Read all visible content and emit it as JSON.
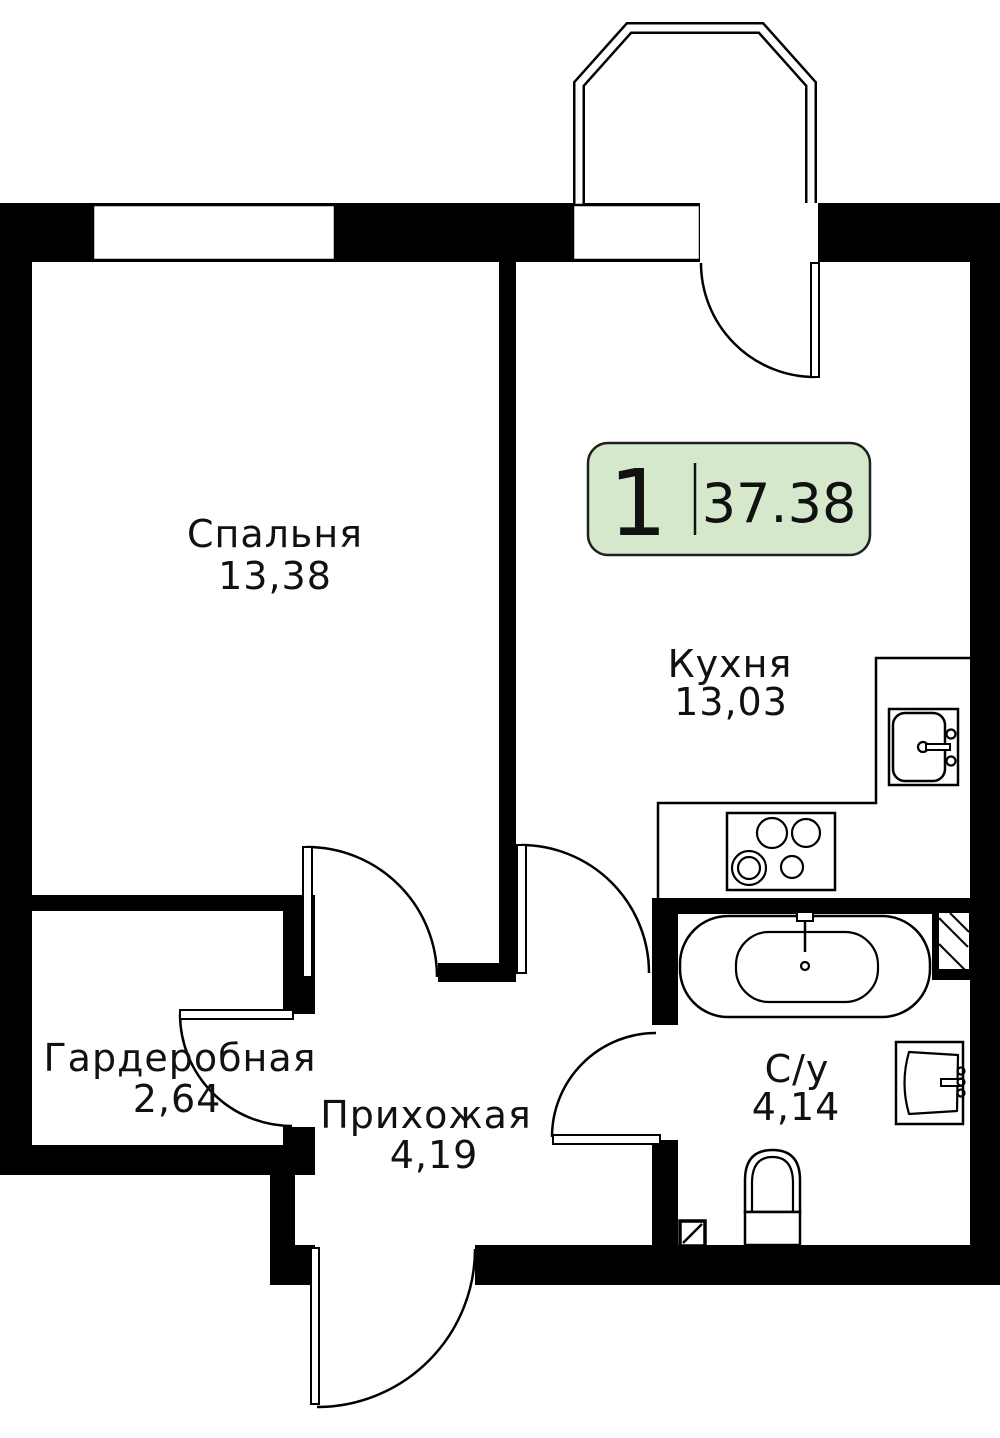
{
  "floorplan": {
    "type": "apartment-floor-plan",
    "badge": {
      "room_count": "1",
      "total_area": "37.38"
    },
    "rooms": [
      {
        "name": "Спальня",
        "area": "13,38"
      },
      {
        "name": "Кухня",
        "area": "13,03"
      },
      {
        "name": "Гардеробная",
        "area": "2,64"
      },
      {
        "name": "Прихожая",
        "area": "4,19"
      },
      {
        "name": "С/у",
        "area": "4,14"
      }
    ],
    "colors": {
      "wall": "#000000",
      "background": "#ffffff",
      "badge_fill": "#d5e8cc",
      "badge_border": "#1f1f1f",
      "text": "#111111"
    },
    "fixtures": [
      "bay-window",
      "bedroom-window",
      "balcony-door",
      "bedroom-door",
      "kitchen-door",
      "wardrobe-door",
      "bathroom-door",
      "entrance-door",
      "kitchen-counter",
      "kitchen-sink",
      "cooktop",
      "bathtub",
      "wash-basin",
      "toilet",
      "ventilation-shaft"
    ]
  }
}
